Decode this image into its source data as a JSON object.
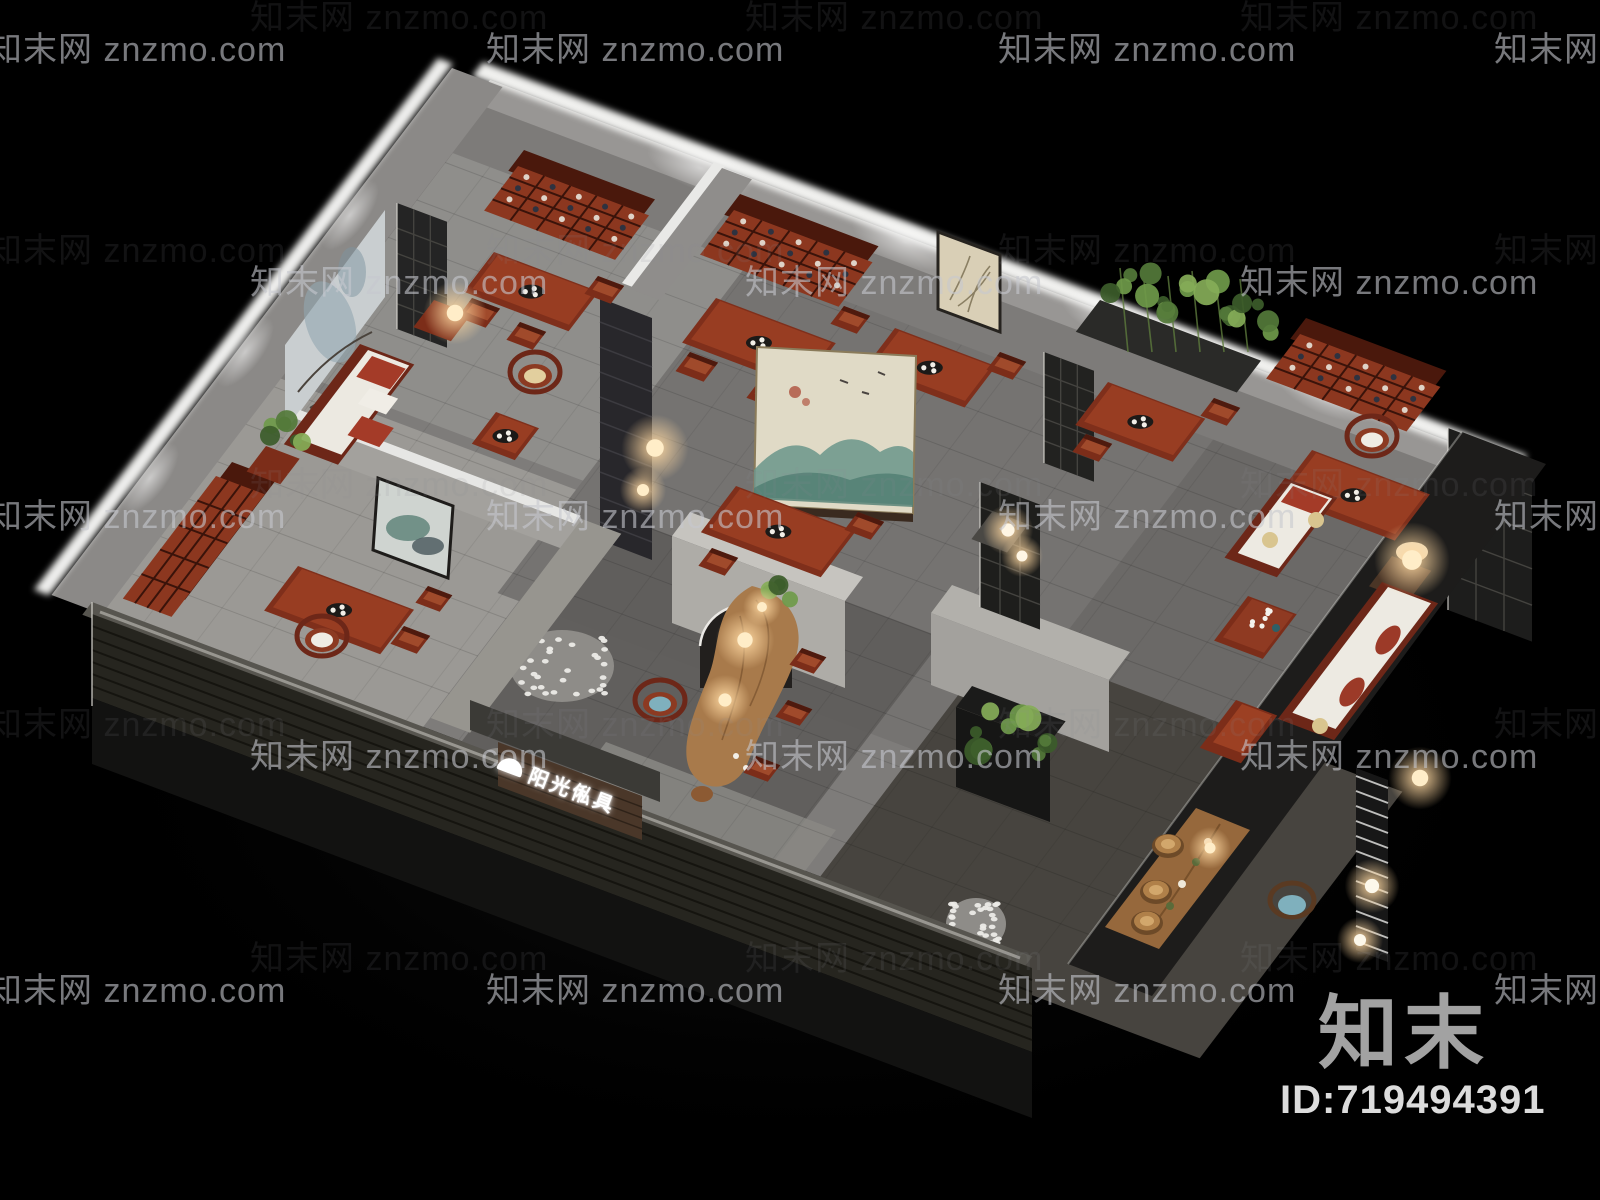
{
  "scene": {
    "label": "chinese-teahouse-furniture-showroom-cutaway-3d-render"
  },
  "watermark": {
    "text": "知末网 znzmo.com",
    "color": "#c6c8cd"
  },
  "brand": {
    "logo_text": "知末",
    "id_text": "ID:719494391"
  },
  "storefront_sign": {
    "text": "阳光俬具"
  },
  "palette": {
    "background": "#000000",
    "wall_light": "#efefed",
    "wall_face": "#807e7c",
    "floor": "#7e7c7a",
    "wood_red": "#8c371f",
    "wood_dark": "#5f2113",
    "lamp_glow": "#ffd9a2",
    "plant_green": "#54793a",
    "brick_dark": "#23211f",
    "screen_painting_teal": "#6a958a",
    "id_text_color": "#dcdcdc",
    "logo_color": "#a2a2a2"
  }
}
